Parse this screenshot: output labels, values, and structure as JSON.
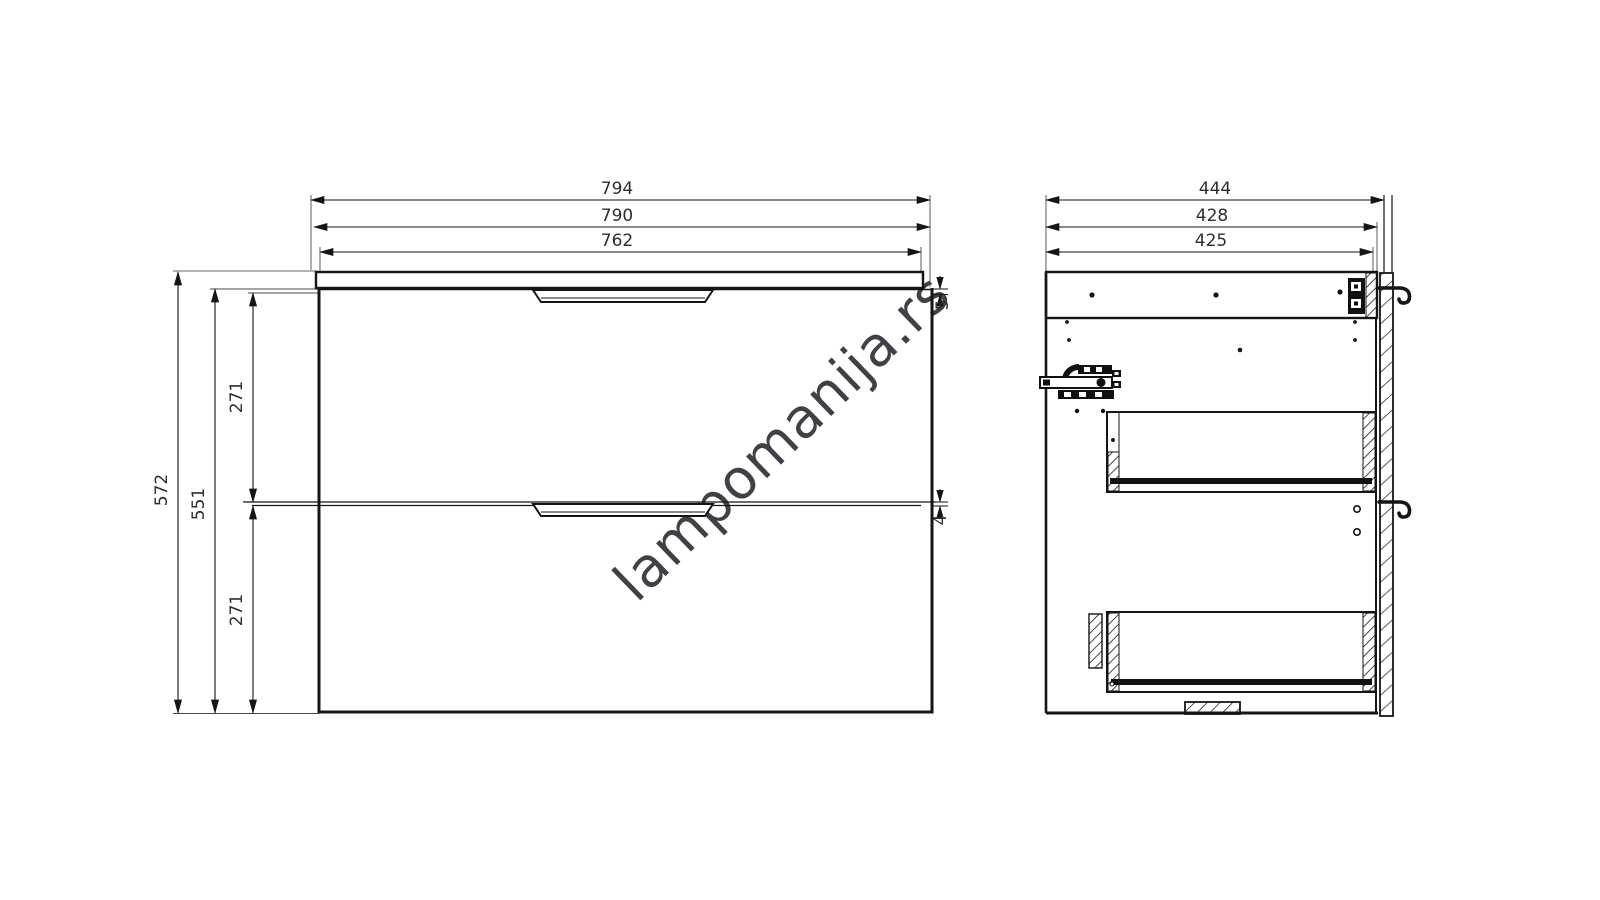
{
  "watermark": {
    "text": "lampomanija.rs",
    "color": "#d2d2d2"
  },
  "front_view": {
    "width_dims": [
      {
        "value": "794"
      },
      {
        "value": "790"
      },
      {
        "value": "762"
      }
    ],
    "height_dims": [
      {
        "value": "572"
      },
      {
        "value": "551"
      },
      {
        "value": "271"
      },
      {
        "value": "271"
      }
    ],
    "gap_dims": [
      {
        "value": "5"
      },
      {
        "value": "4"
      }
    ]
  },
  "side_view": {
    "depth_dims": [
      {
        "value": "444"
      },
      {
        "value": "428"
      },
      {
        "value": "425"
      }
    ]
  },
  "colors": {
    "line": "#151515",
    "dim_text": "#2c2c34",
    "watermark": "#d2d2d2",
    "extension_gray": "#9a9a9a",
    "background": "#ffffff"
  }
}
